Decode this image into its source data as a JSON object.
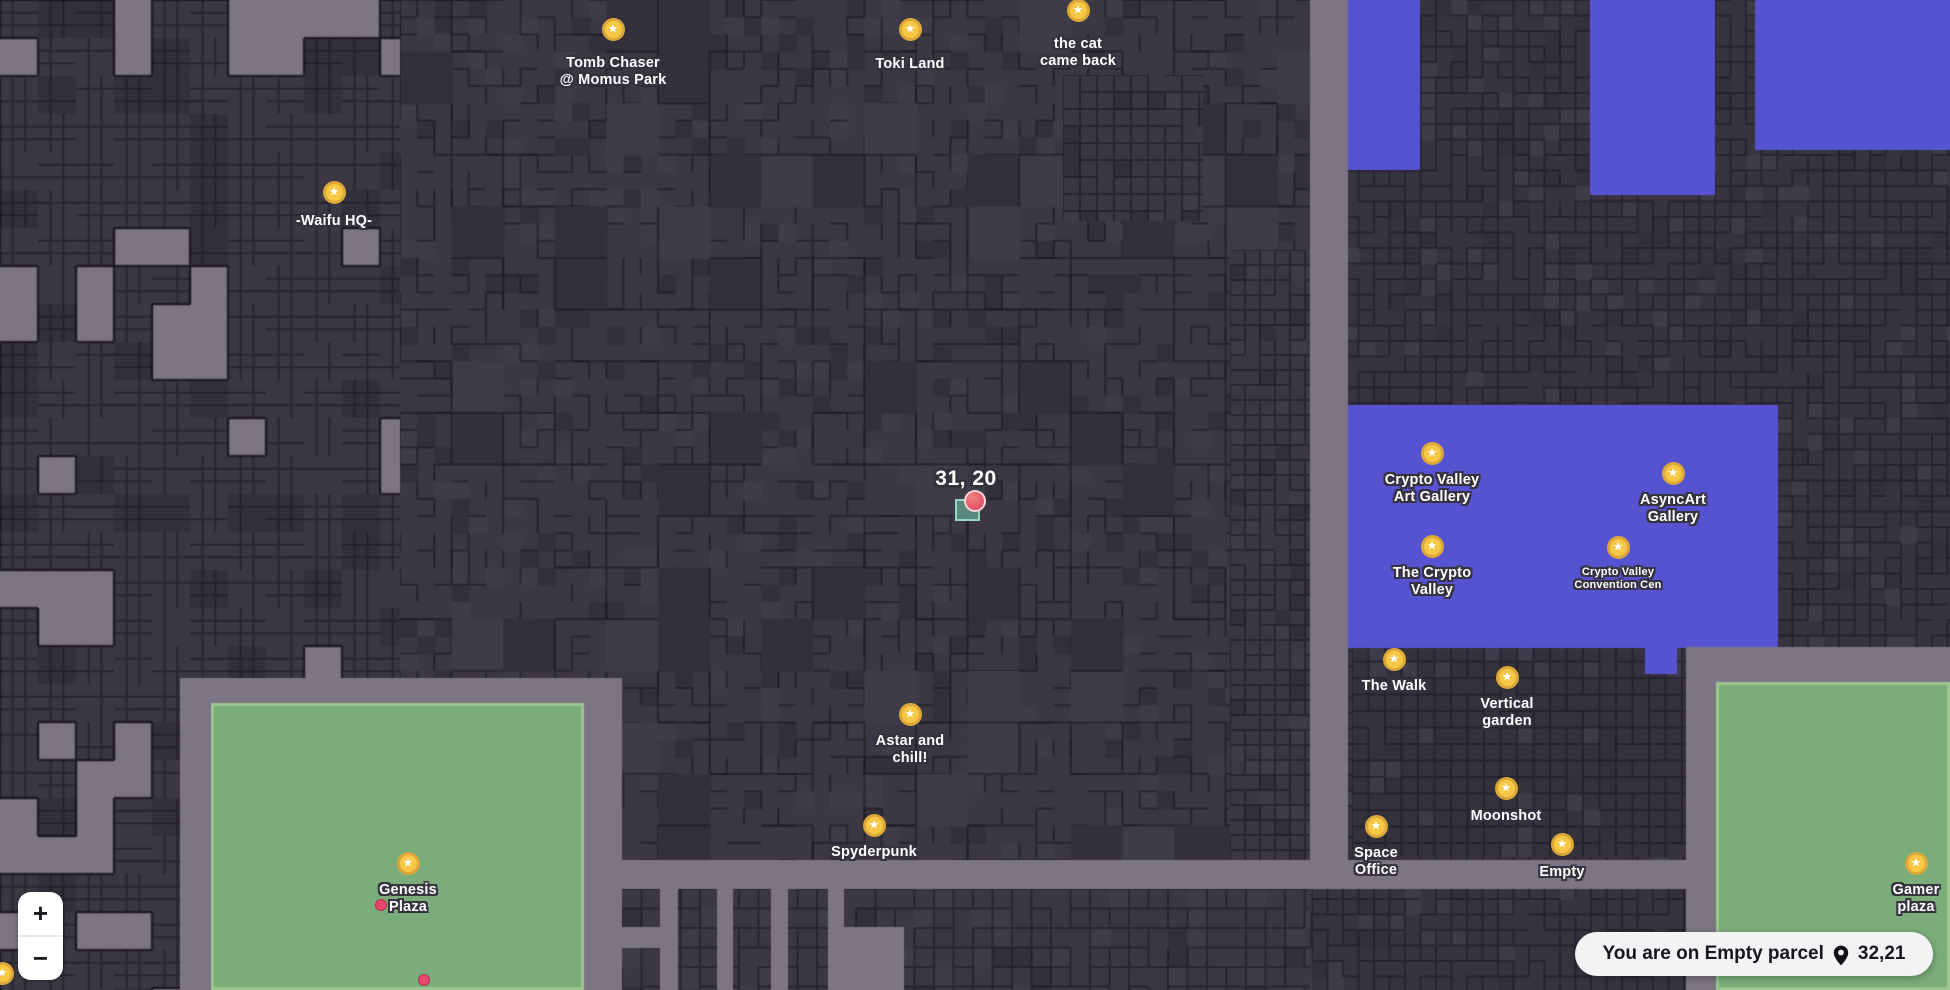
{
  "map": {
    "colors": {
      "road": "#7b7584",
      "parcel": "#3b3844",
      "parcel_dark": "#33303c",
      "parcel_light": "#3f3c49",
      "parcel_line": "rgba(24,22,32,0.55)",
      "cluster_line": "rgba(22,20,30,0.8)",
      "district_blue": "#5653d1",
      "plaza_green": "#7bad7a",
      "plaza_green_edge": "#9ec48f",
      "marker_gold": "#f6c846",
      "marker_gold_ring": "#dda83a",
      "user_dot_pink": "#e8476f",
      "selection_teal": "rgba(96,152,136,0.85)",
      "position_red": "#e25468"
    },
    "markers": [
      {
        "id": "tomb-chaser-momus-park",
        "lines": [
          "Tomb Chaser",
          "@ Momus Park"
        ],
        "x": 613,
        "y": 29,
        "label_top": 55
      },
      {
        "id": "toki-land",
        "lines": [
          "Toki Land"
        ],
        "x": 910,
        "y": 29,
        "label_top": 56
      },
      {
        "id": "the-cat-came-back",
        "lines": [
          "the cat",
          "came back"
        ],
        "x": 1078,
        "y": 10,
        "label_top": 36
      },
      {
        "id": "waifu-hq",
        "lines": [
          "-Waifu HQ-"
        ],
        "x": 334,
        "y": 192,
        "label_top": 213
      },
      {
        "id": "crypto-valley-art-gallery",
        "lines": [
          "Crypto Valley",
          "Art Gallery"
        ],
        "x": 1432,
        "y": 453,
        "label_top": 472
      },
      {
        "id": "asyncart-gallery",
        "lines": [
          "AsyncArt",
          "Gallery"
        ],
        "x": 1673,
        "y": 473,
        "label_top": 492
      },
      {
        "id": "the-crypto-valley",
        "lines": [
          "The Crypto",
          "Valley"
        ],
        "x": 1432,
        "y": 546,
        "label_top": 565
      },
      {
        "id": "crypto-valley-convention-cen",
        "lines": [
          "Crypto Valley",
          "Convention Cen"
        ],
        "x": 1618,
        "y": 547,
        "label_top": 566,
        "small": true
      },
      {
        "id": "the-walk",
        "lines": [
          "The Walk"
        ],
        "x": 1394,
        "y": 659,
        "label_top": 678
      },
      {
        "id": "vertical-garden",
        "lines": [
          "Vertical",
          "garden"
        ],
        "x": 1507,
        "y": 677,
        "label_top": 696
      },
      {
        "id": "moonshot",
        "lines": [
          "Moonshot"
        ],
        "x": 1506,
        "y": 788,
        "label_top": 808
      },
      {
        "id": "space-office",
        "lines": [
          "Space",
          "Office"
        ],
        "x": 1376,
        "y": 826,
        "label_top": 845
      },
      {
        "id": "empty",
        "lines": [
          "Empty"
        ],
        "x": 1562,
        "y": 844,
        "label_top": 864
      },
      {
        "id": "gamer-plaza",
        "lines": [
          "Gamer",
          "plaza"
        ],
        "x": 1916,
        "y": 863,
        "label_top": 882
      },
      {
        "id": "genesis-plaza",
        "lines": [
          "Genesis",
          "Plaza"
        ],
        "x": 408,
        "y": 863,
        "label_top": 882
      },
      {
        "id": "astar-and-chill",
        "lines": [
          "Astar and",
          "chill!"
        ],
        "x": 910,
        "y": 714,
        "label_top": 733
      },
      {
        "id": "spyderpunk",
        "lines": [
          "Spyderpunk"
        ],
        "x": 874,
        "y": 825,
        "label_top": 844
      },
      {
        "id": "edge-marker",
        "lines": [],
        "x": 2,
        "y": 973,
        "label_top": 0
      }
    ],
    "position_marker": {
      "label": "31, 20",
      "label_x": 966,
      "label_top": 467,
      "square": {
        "x": 955,
        "y": 499,
        "w": 25,
        "h": 22
      },
      "dot": {
        "x": 975,
        "y": 501,
        "r": 11
      }
    },
    "user_dots": [
      {
        "x": 381,
        "y": 905,
        "r": 6
      },
      {
        "x": 424,
        "y": 980,
        "r": 6
      }
    ]
  },
  "controls": {
    "zoom_in": "+",
    "zoom_out": "−"
  },
  "status_bar": {
    "message": "You are on Empty parcel",
    "coordinates": "32,21"
  }
}
